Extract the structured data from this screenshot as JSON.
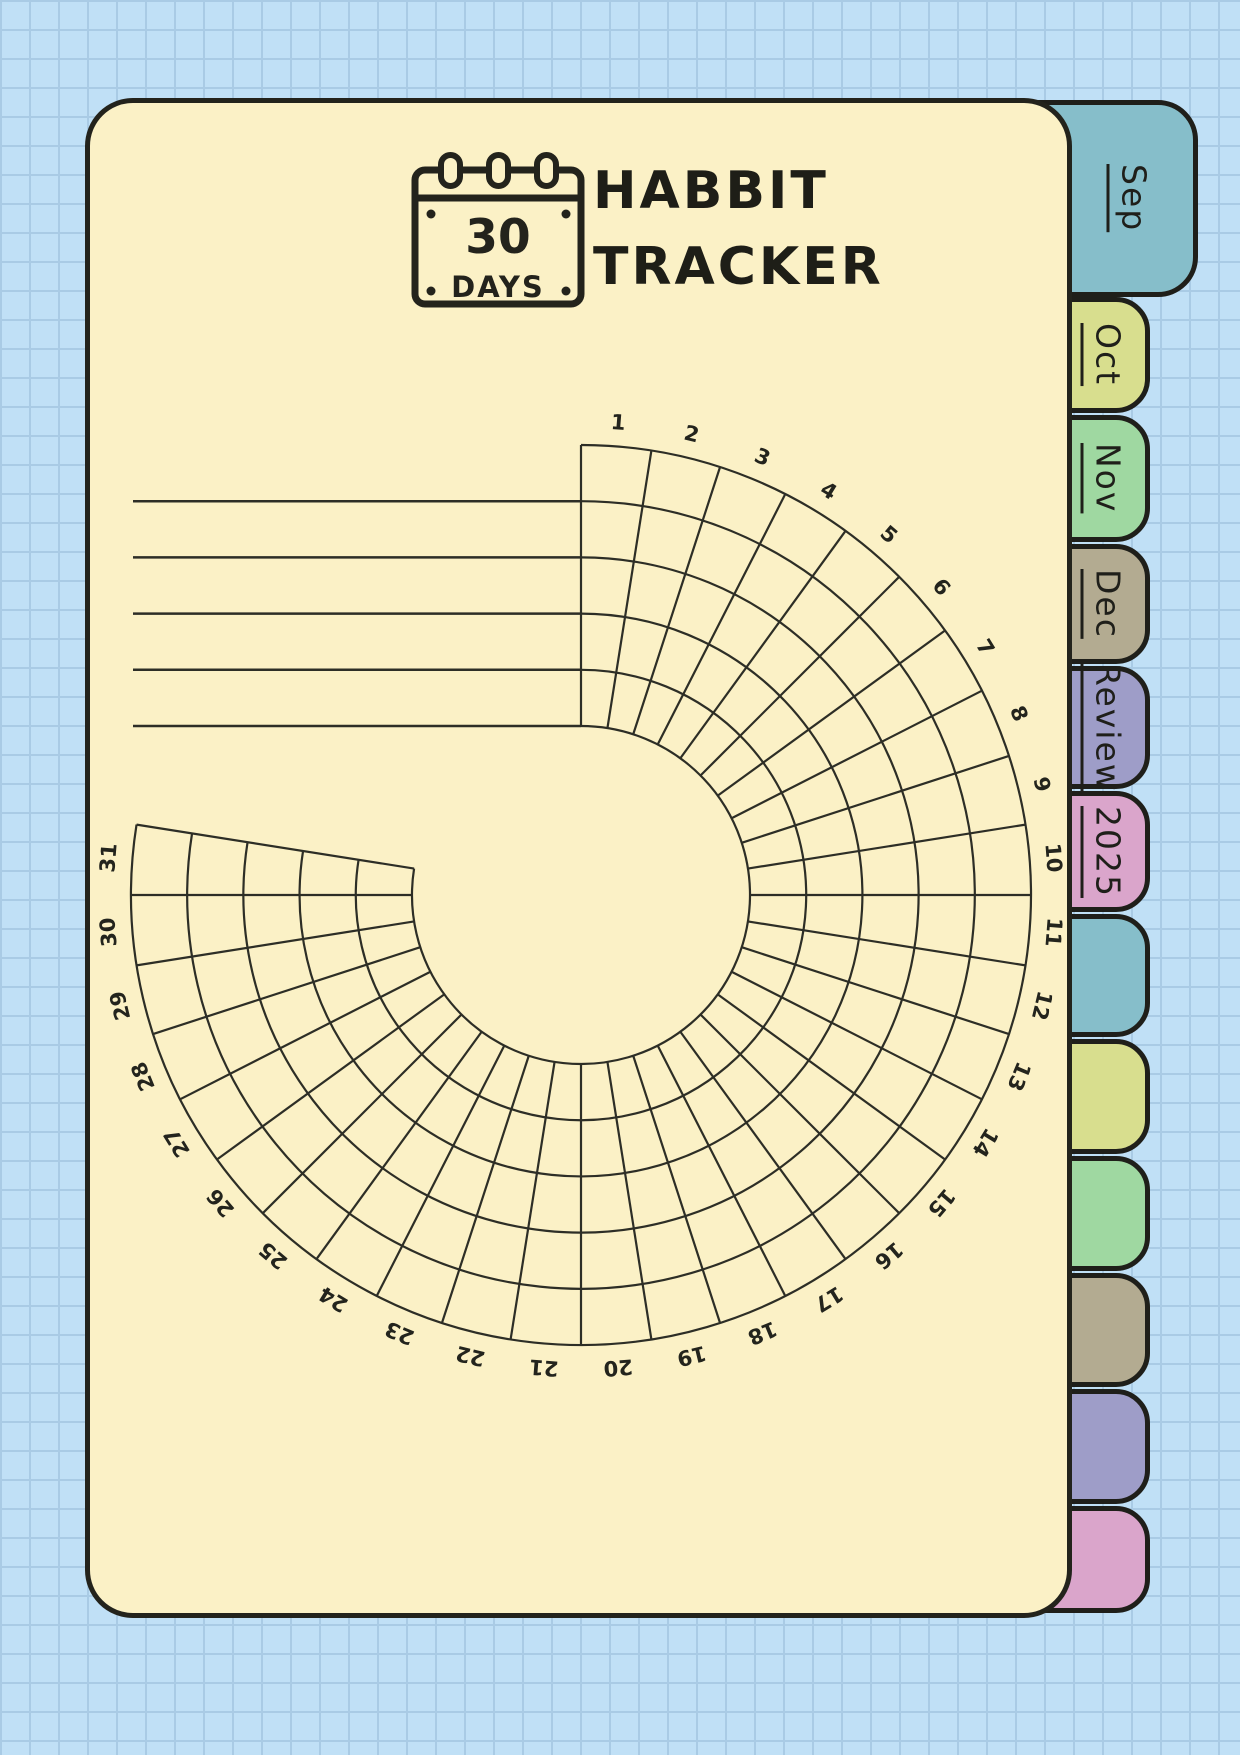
{
  "page": {
    "title_line1": "HABBIT",
    "title_line2": "TRACKER",
    "calendar_badge": {
      "number": "30",
      "label": "DAYS"
    }
  },
  "colors": {
    "background": "#C0E0F6",
    "background_grid_line": "#A9CBE5",
    "page_fill": "#FBF1C6",
    "ink": "#23231C",
    "chart_line": "#2D2E26",
    "tab_teal": "#86BECA",
    "tab_yellow_green": "#D8DE8E",
    "tab_green": "#9FD8A1",
    "tab_tan": "#B3AB91",
    "tab_lavender": "#9E9DC8",
    "tab_pink": "#DAA5CB"
  },
  "tabs": [
    {
      "label": "Sep",
      "color": "#86BECA",
      "active": true
    },
    {
      "label": "Oct",
      "color": "#D8DE8E",
      "active": false
    },
    {
      "label": "Nov",
      "color": "#9FD8A1",
      "active": false
    },
    {
      "label": "Dec",
      "color": "#B3AB91",
      "active": false
    },
    {
      "label": "Review",
      "color": "#9E9DC8",
      "active": false
    },
    {
      "label": "2025",
      "color": "#DAA5CB",
      "active": false
    },
    {
      "label": "",
      "color": "#86BECA",
      "active": false
    },
    {
      "label": "",
      "color": "#D8DE8E",
      "active": false
    },
    {
      "label": "",
      "color": "#9FD8A1",
      "active": false
    },
    {
      "label": "",
      "color": "#B3AB91",
      "active": false
    },
    {
      "label": "",
      "color": "#9E9DC8",
      "active": false
    },
    {
      "label": "",
      "color": "#DAA5CB",
      "active": false
    }
  ],
  "chart_data": {
    "type": "radial-habit-grid",
    "title": "30 day habit tracker wheel",
    "days": 31,
    "day_labels": [
      "1",
      "2",
      "3",
      "4",
      "5",
      "6",
      "7",
      "8",
      "9",
      "10",
      "11",
      "12",
      "13",
      "14",
      "15",
      "16",
      "17",
      "18",
      "19",
      "20",
      "21",
      "22",
      "23",
      "24",
      "25",
      "26",
      "27",
      "28",
      "29",
      "30",
      "31"
    ],
    "rings": 5,
    "habit_rows": 5,
    "habit_row_values": [
      "",
      "",
      "",
      "",
      ""
    ],
    "degrees_per_day": 9,
    "start_angle_deg": 0,
    "total_span_deg": 279,
    "center": {
      "x": 581,
      "y": 895
    },
    "inner_radius": 169,
    "outer_radius": 450,
    "label_radius": 467,
    "habit_line_x_start": 133,
    "grid_on": true,
    "legend": "none",
    "cells_filled": []
  }
}
